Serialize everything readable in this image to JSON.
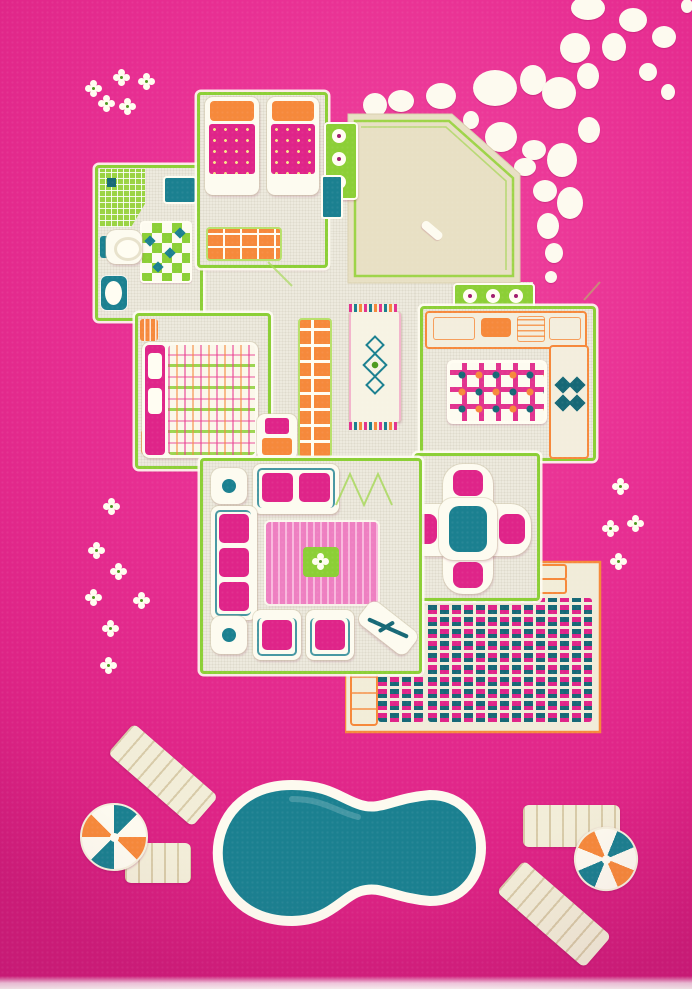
{
  "scene": {
    "subject": "children's 3D play rug: dollhouse floor plan with garden pool",
    "style": "top-down carved pile carpet, hot pink ground",
    "rooms": [
      "kids bedroom",
      "bathroom",
      "master bedroom",
      "hallway",
      "kitchen",
      "dining room",
      "living room",
      "entrance terrace",
      "patio"
    ],
    "outdoor_items": [
      "stepping-stone path",
      "kidney-shaped swimming pool",
      "four sun loungers",
      "two pinwheel parasols",
      "white flower motifs"
    ],
    "furniture": [
      "two single beds",
      "green wardrobe",
      "toilet",
      "sink",
      "shower tiles",
      "double bed with plaid duvet",
      "orange bookshelf",
      "nightstand",
      "runner rug",
      "kitchen counters with stove and sink",
      "checkered kitchen rug",
      "round dining table with four chairs",
      "loveseat",
      "three-seat sofa",
      "two armchairs",
      "striped living rug",
      "side tables",
      "flower box"
    ]
  },
  "palette": {
    "pink_bg": "#e82f93",
    "pink_deep": "#d01d7b",
    "magenta": "#df2489",
    "pink_light": "#f6a8d4",
    "cream": "#f4efdd",
    "beige": "#e8e0c4",
    "floor": "#edeade",
    "green": "#8ccf36",
    "green_dark": "#6fae22",
    "orange": "#f6893b",
    "teal": "#1b8090",
    "teal_d": "#176876",
    "white": "#fffdf2"
  },
  "pebbles": [
    [
      588,
      8,
      17,
      12
    ],
    [
      633,
      20,
      14,
      12
    ],
    [
      664,
      37,
      12,
      11
    ],
    [
      687,
      6,
      6,
      7
    ],
    [
      575,
      48,
      15,
      15
    ],
    [
      614,
      47,
      12,
      14
    ],
    [
      648,
      72,
      9,
      9
    ],
    [
      668,
      92,
      7,
      8
    ],
    [
      495,
      88,
      22,
      18
    ],
    [
      533,
      80,
      13,
      15
    ],
    [
      559,
      93,
      17,
      16
    ],
    [
      588,
      76,
      11,
      13
    ],
    [
      375,
      105,
      12,
      12
    ],
    [
      401,
      101,
      13,
      11
    ],
    [
      441,
      96,
      15,
      13
    ],
    [
      471,
      120,
      8,
      9
    ],
    [
      501,
      137,
      16,
      15
    ],
    [
      534,
      150,
      12,
      10
    ],
    [
      562,
      160,
      15,
      17
    ],
    [
      589,
      130,
      11,
      13
    ],
    [
      525,
      167,
      11,
      9
    ],
    [
      545,
      191,
      12,
      11
    ],
    [
      570,
      203,
      13,
      16
    ],
    [
      548,
      226,
      11,
      13
    ],
    [
      554,
      253,
      9,
      10
    ],
    [
      551,
      277,
      6,
      6
    ]
  ],
  "flowers": [
    [
      90,
      85
    ],
    [
      118,
      74
    ],
    [
      143,
      78
    ],
    [
      103,
      100
    ],
    [
      124,
      103
    ],
    [
      108,
      503
    ],
    [
      93,
      547
    ],
    [
      115,
      568
    ],
    [
      90,
      594
    ],
    [
      138,
      597
    ],
    [
      107,
      625
    ],
    [
      105,
      662
    ],
    [
      617,
      483
    ],
    [
      607,
      525
    ],
    [
      632,
      520
    ],
    [
      615,
      558
    ]
  ]
}
